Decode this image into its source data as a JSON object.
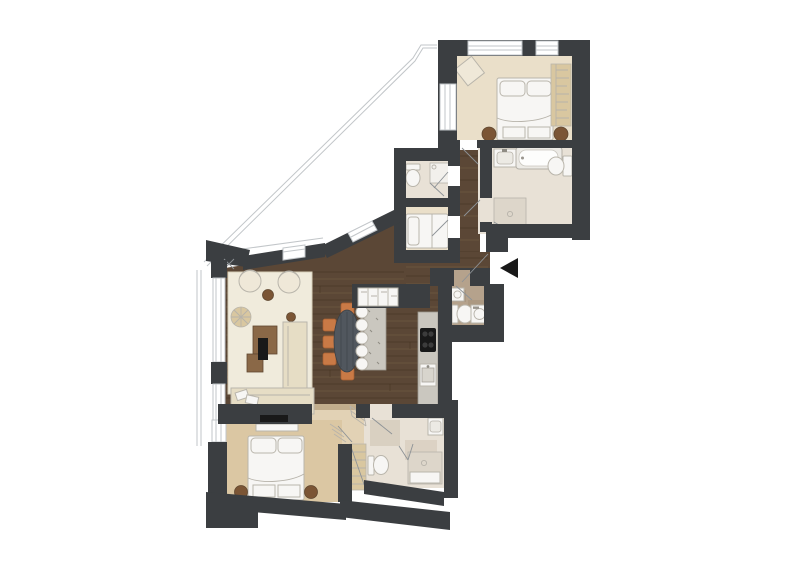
{
  "page": {
    "title": "apartment-floor-plan",
    "background": "#ffffff"
  },
  "palette": {
    "wall": "#3b3e41",
    "wood": "#5b4736",
    "plankDark": "#43321f",
    "plankLight": "#7a6148",
    "carpet": "#eadfc9",
    "carpetTan": "#dbc7a3",
    "tile": "#e8e1d6",
    "tileDark": "#b5a28c",
    "rug": "#f0ebdc",
    "rugEdge": "#d9d1bb",
    "furnWhite": "#f7f6f4",
    "furnCream": "#efe8d8",
    "furnBeige": "#e6ddc5",
    "furnTan": "#d9c7a0",
    "furnWood": "#8a6847",
    "furnWoodDark": "#5f4730",
    "brown": "#7b5535",
    "accentOrange": "#c97a46",
    "tableDark": "#51575e",
    "island": "#cac7bf",
    "black": "#191919",
    "thinLine": "#c2c6c9",
    "swing": "#8d9296",
    "furnLine": "#b9b5ab"
  },
  "rooms": [
    {
      "id": "master-bedroom",
      "name": "bedroom"
    },
    {
      "id": "master-bathroom",
      "name": "bathroom"
    },
    {
      "id": "guest-shower-wc",
      "name": "shower wc"
    },
    {
      "id": "small-bedroom",
      "name": "small bedroom"
    },
    {
      "id": "living-dining-kitchen",
      "name": "living / dining / kitchen"
    },
    {
      "id": "wc-laundry",
      "name": "wc / laundry"
    },
    {
      "id": "hallway",
      "name": "hallway"
    },
    {
      "id": "second-bedroom",
      "name": "bedroom 2"
    },
    {
      "id": "second-bathroom",
      "name": "bathroom 2"
    },
    {
      "id": "closet",
      "name": "closet"
    },
    {
      "id": "terrace",
      "name": "terrace"
    }
  ],
  "furniture": {
    "master_bedroom": [
      "double bed",
      "wardrobe",
      "armchair",
      "two round stools"
    ],
    "master_bathroom": [
      "vanity sink",
      "bathtub",
      "toilet",
      "shower"
    ],
    "guest_shower_wc": [
      "toilet",
      "shower"
    ],
    "small_bedroom": [
      "single bed"
    ],
    "living": [
      "rug",
      "two armchairs",
      "pouf",
      "coffee tables",
      "sofa",
      "daybed",
      "tv"
    ],
    "dining": [
      "oval table",
      "five chairs"
    ],
    "kitchen": [
      "island",
      "five bar stools",
      "sideboard",
      "counter with cooktop and sink"
    ],
    "wc_laundry": [
      "sink",
      "toilet",
      "washing machine"
    ],
    "second_bedroom": [
      "double bed",
      "two nightstands",
      "tv"
    ],
    "second_bathroom": [
      "sink",
      "toilet",
      "walk-in shower"
    ],
    "closet": [
      "shelving"
    ]
  },
  "entrance": {
    "symbol": "arrow-left"
  }
}
